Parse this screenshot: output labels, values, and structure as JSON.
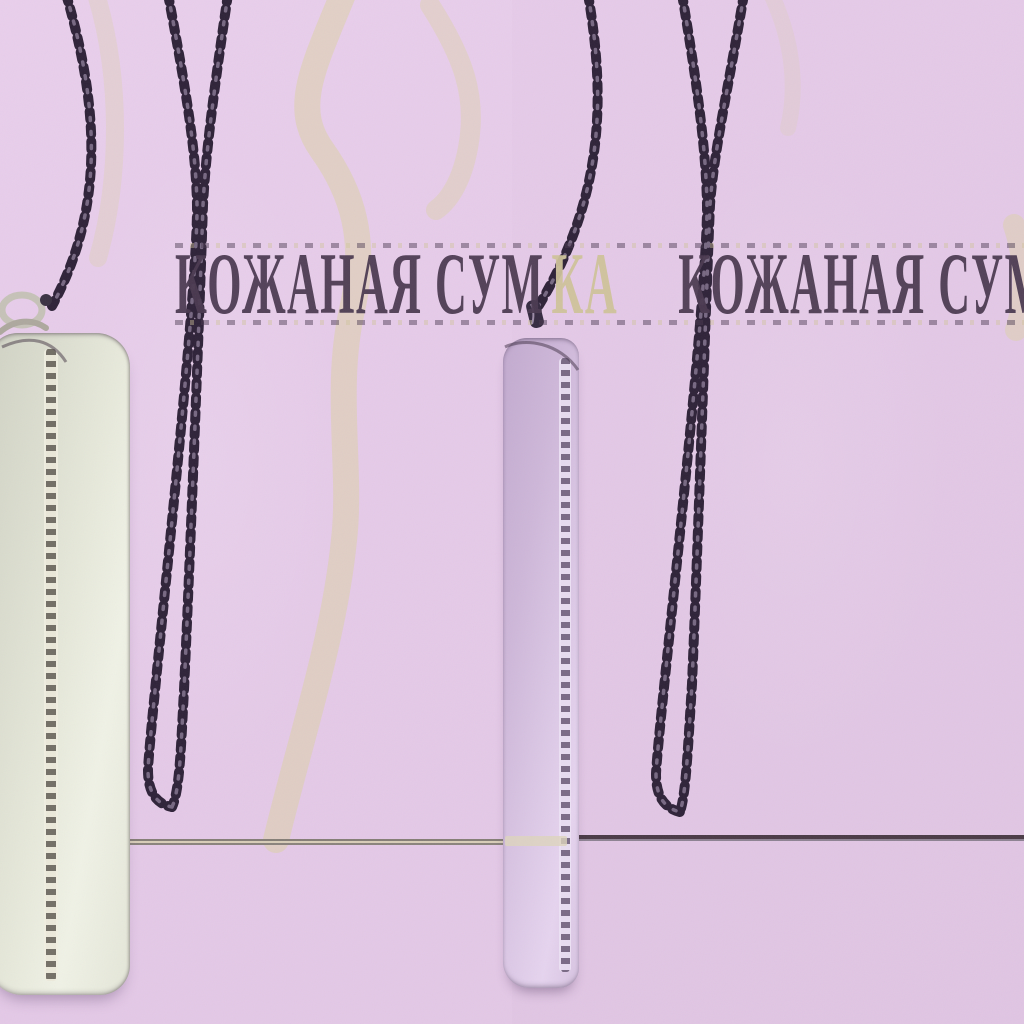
{
  "scene": {
    "description": "Product photo collage: two small leather phone pouches on long dark chain straps hang against a lilac backdrop decorated with pale beige script; a thin table edge line crosses behind them",
    "panels": [
      {
        "side": "left",
        "item": "cream leather zip phone pouch",
        "strap": "dark chain strap with silver clasp"
      },
      {
        "side": "right",
        "item": "lilac leather zip phone pouch",
        "strap": "dark chain strap"
      }
    ]
  },
  "overlay": {
    "full_phrase": "КОЖАНАЯ СУМКА",
    "segments": [
      {
        "text": "КОЖАНАЯ СУМ",
        "color": "#4a3950"
      },
      {
        "text": "КА",
        "color": "#cfc39a"
      },
      {
        "text": "КОЖАНАЯ СУМ",
        "color": "#4a3950"
      }
    ]
  },
  "colors": {
    "background_left": "#e7cdea",
    "background_right": "#e2c7e5",
    "text_dark": "#4a3950",
    "text_beige": "#cfc39a",
    "backdrop_script_beige": "#dcd2a2",
    "chain_dark": "#2e2238",
    "chain_highlight": "#8a7a95",
    "bag_left_cream": "#e8eadc",
    "bag_right_lilac": "#d9c5e3",
    "zipper_metal_left": "#5f5a52",
    "zipper_metal_right": "#70607c",
    "hardware_silver": "#c6c2b8",
    "table_line_left": "#857e76",
    "table_line_right": "#4a3a46"
  }
}
